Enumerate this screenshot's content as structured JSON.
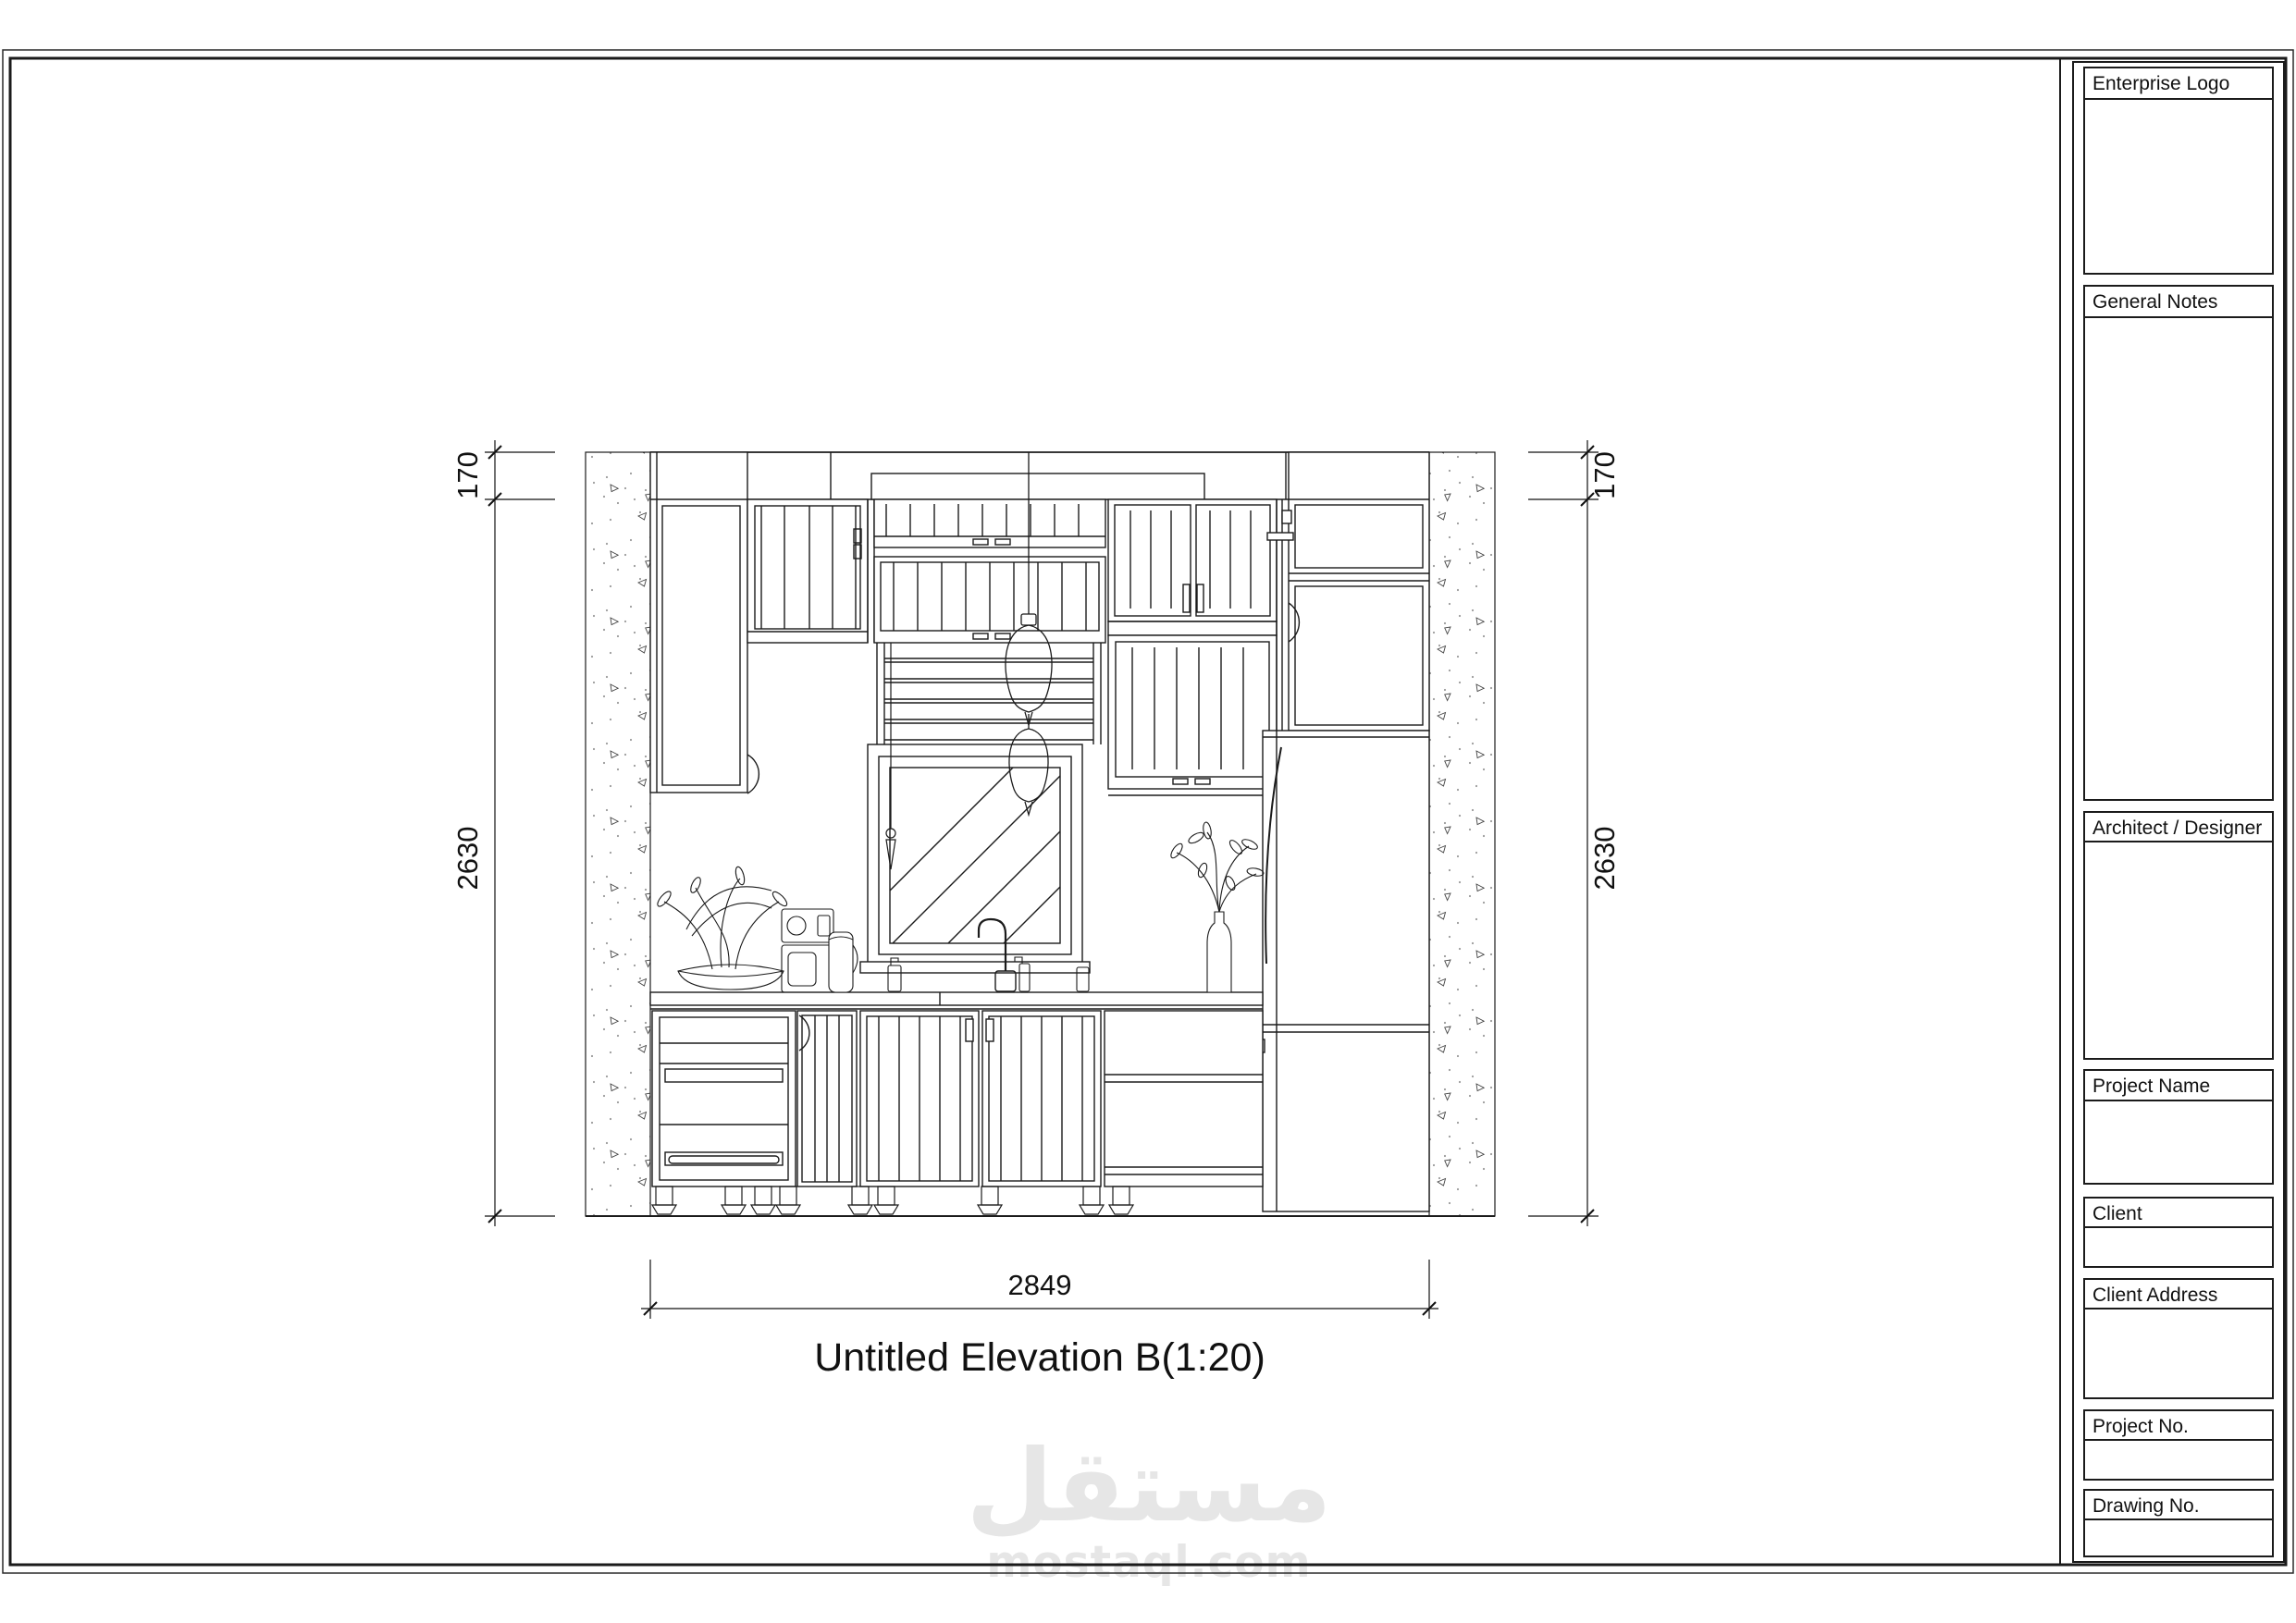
{
  "page": {
    "background": "#ffffff",
    "line_color": "#1b1b1b"
  },
  "drawing": {
    "title": "Untitled Elevation B(1:20)",
    "dimensions": {
      "soffit_left": "170",
      "height_left": "2630",
      "soffit_right": "170",
      "height_right": "2630",
      "width_bottom": "2849"
    }
  },
  "title_block": {
    "sections": [
      {
        "label": "Enterprise Logo"
      },
      {
        "label": "General Notes"
      },
      {
        "label": "Architect / Designer"
      },
      {
        "label": "Project Name"
      },
      {
        "label": "Client"
      },
      {
        "label": "Client Address"
      },
      {
        "label": "Project No."
      },
      {
        "label": "Drawing No."
      }
    ]
  },
  "watermark": {
    "arabic": "مستقل",
    "latin": "mostaql.com",
    "color": "#e6e6e6"
  }
}
